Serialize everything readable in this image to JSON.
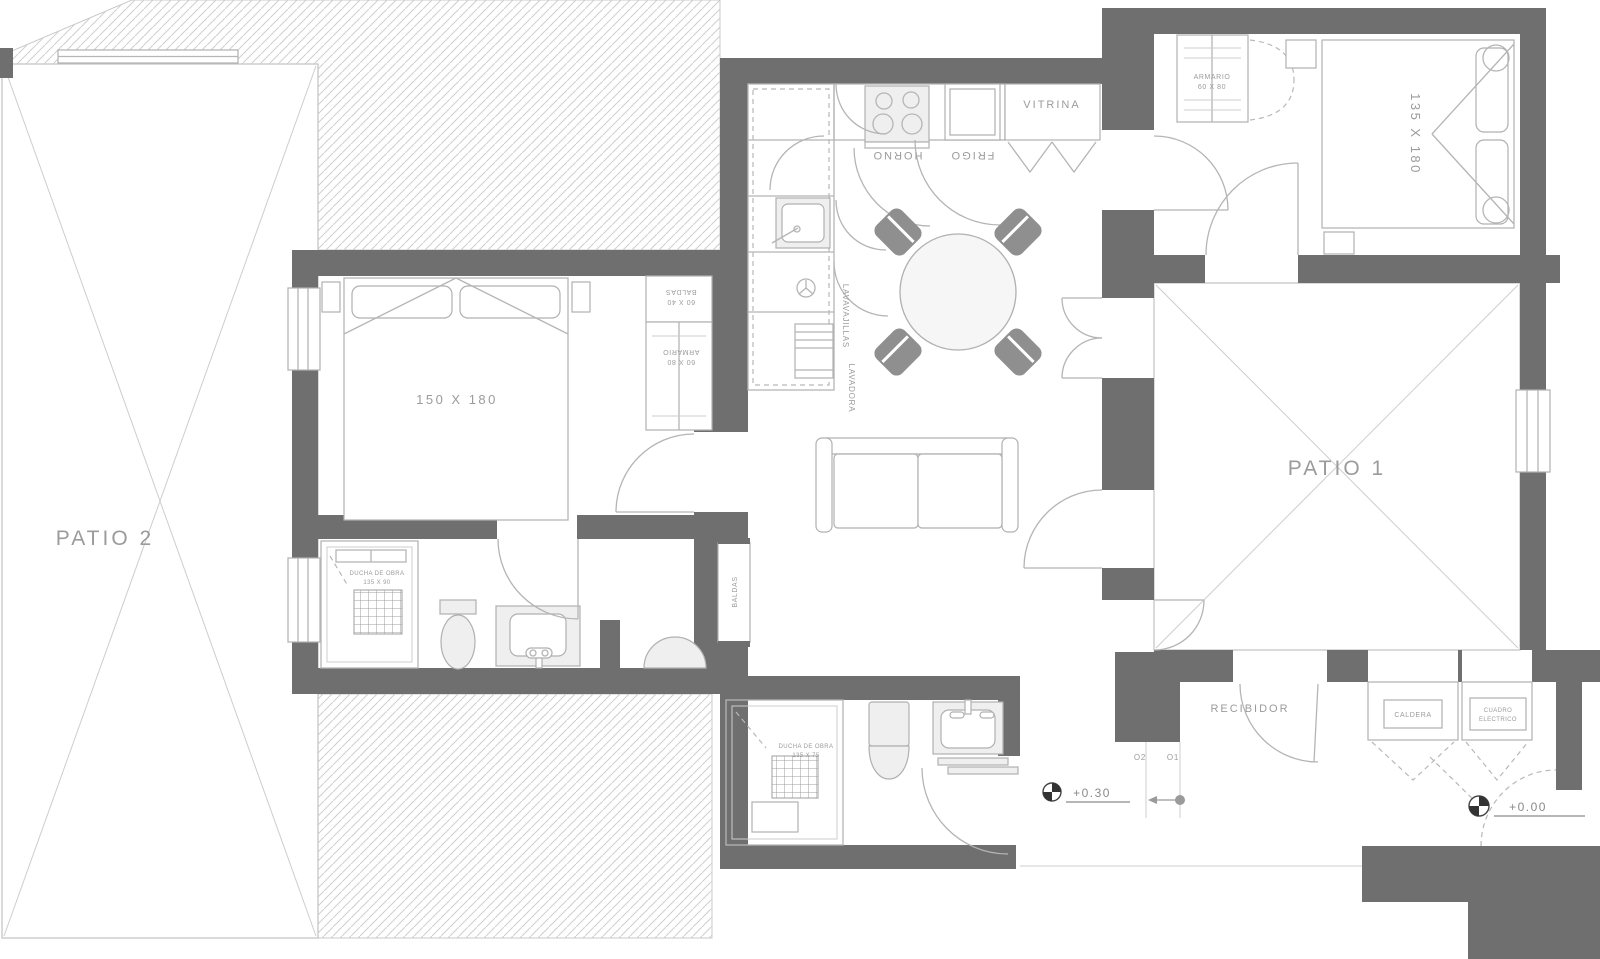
{
  "drawing": {
    "patios": {
      "patio1": "PATIO 1",
      "patio2": "PATIO 2"
    },
    "bedrooms": {
      "bed1_size": "150 X 180",
      "bed2_size": "135 X 180"
    },
    "kitchen": {
      "vitrina": "VITRINA",
      "horno": "HORNO",
      "frigo": "FRIGO",
      "lavavajillas": "LAVAVAJILLAS",
      "lavadora": "LAVADORA"
    },
    "storage": {
      "armario_dorm2": "ARMARIO",
      "armario_dorm2_size": "60 X 80",
      "baldas": "BALDAS",
      "baldas_size": "60 X 40",
      "armario_dorm1": "ARMARIO",
      "armario_dorm1_size": "60 X 80",
      "baldas_niche": "BALDAS"
    },
    "bathrooms": {
      "ducha1": "DUCHA DE OBRA",
      "ducha1_size": "135 X 90",
      "ducha2": "DUCHA DE OBRA",
      "ducha2_size": "135 X 75"
    },
    "entry": {
      "recibidor": "RECIBIDOR",
      "caldera": "CALDERA",
      "cuadro_line1": "CUADRO",
      "cuadro_line2": "ELECTRICO"
    },
    "levels": {
      "living": "+0.30",
      "entry": "+0.00"
    },
    "doors": {
      "o1": "O1",
      "o2": "O2"
    },
    "colors": {
      "wall": "#6f6f6f",
      "hatch": "#cfcfcf",
      "line": "#b5b5b5",
      "text": "#9b9b9b"
    }
  }
}
